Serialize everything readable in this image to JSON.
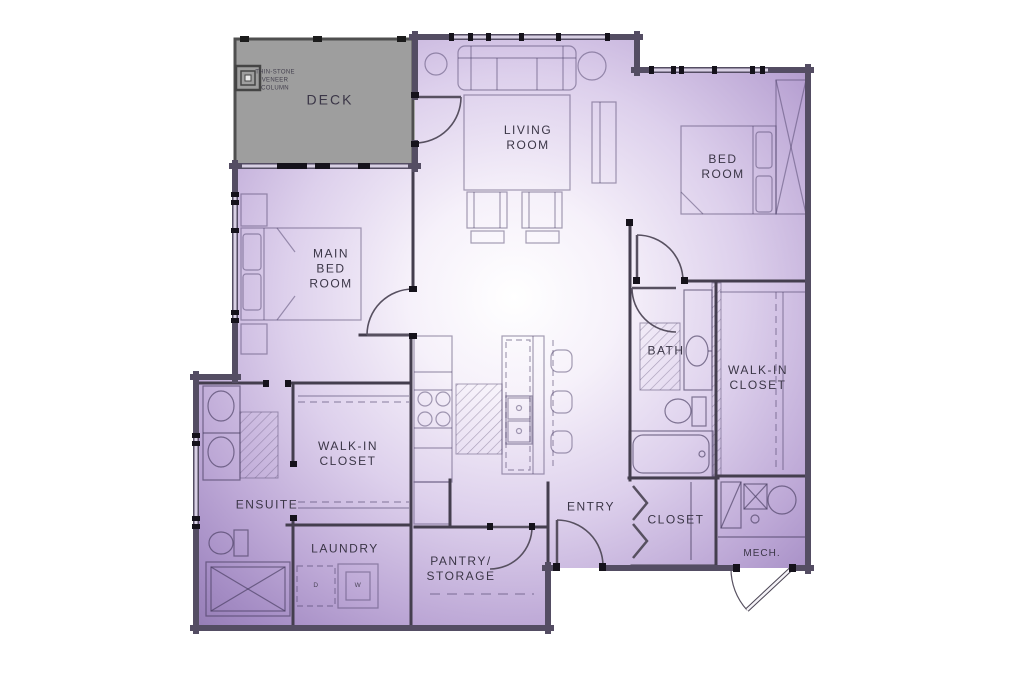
{
  "plan": {
    "colors": {
      "background": "#ffffff",
      "unit_fill_center": "#ffffff",
      "unit_fill_mid": "#d9cbe9",
      "unit_fill_edge": "#927ab2",
      "deck_fill": "#9e9e9e",
      "interior_wall": "#443e4e",
      "exterior_wall": "#544d63",
      "window_tick": "#15121b",
      "label_text": "#3b3647",
      "furniture_line": "#5a4e75"
    },
    "rooms": [
      {
        "id": "deck",
        "label": "DECK"
      },
      {
        "id": "living-room",
        "label": "LIVING ROOM"
      },
      {
        "id": "bed-room",
        "label": "BED ROOM"
      },
      {
        "id": "main-bed-room",
        "label": "MAIN BED ROOM"
      },
      {
        "id": "bath",
        "label": "BATH"
      },
      {
        "id": "walk-in-closet-right",
        "label": "WALK-IN CLOSET"
      },
      {
        "id": "walk-in-closet-left",
        "label": "WALK-IN CLOSET"
      },
      {
        "id": "ensuite",
        "label": "ENSUITE"
      },
      {
        "id": "entry",
        "label": "ENTRY"
      },
      {
        "id": "closet",
        "label": "CLOSET"
      },
      {
        "id": "laundry",
        "label": "LAUNDRY"
      },
      {
        "id": "pantry-storage",
        "label": "PANTRY/ STORAGE"
      },
      {
        "id": "mech",
        "label": "MECH."
      }
    ],
    "annotations": {
      "column_note": "THIN-STONE VENEER COLUMN"
    },
    "appliances": {
      "dryer": "D",
      "washer": "W"
    }
  }
}
